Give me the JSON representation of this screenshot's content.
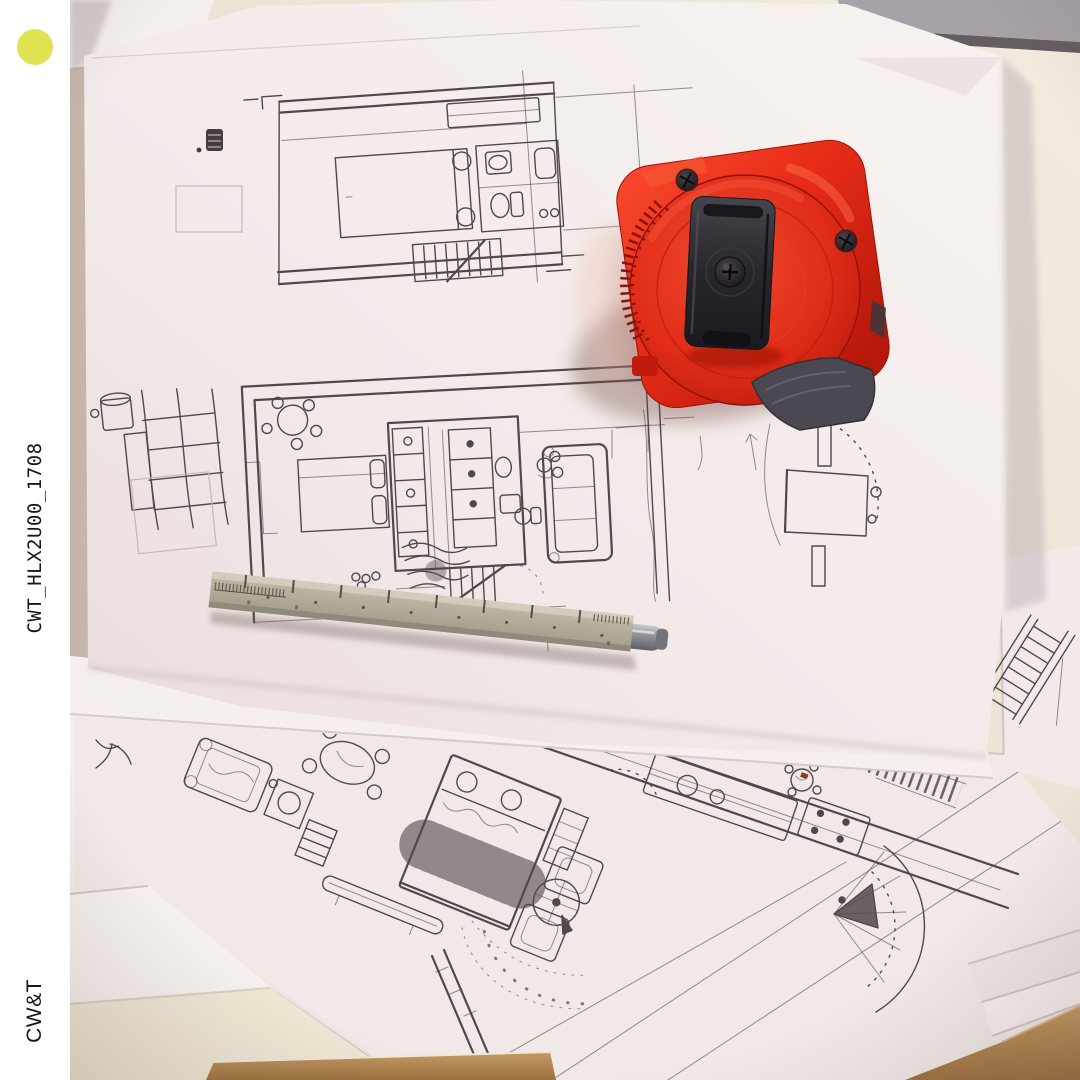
{
  "frame": {
    "background": "#ffffff"
  },
  "sidebar": {
    "dot_color": "#dde351",
    "vertical_label": "CWT_HLX2U00_1708",
    "brand": "CW&T"
  },
  "photo": {
    "alt": "Stacked sheets of hand-drawn apartment floor plan sketches on a table, with a red tape measure and a square beige ruler-pen lying on top",
    "colors": {
      "table_top": "#eae2d3",
      "shelf_gray": "#a7a1a8",
      "paper": "#f4edeb",
      "ink": "#51474c",
      "tape_measure_red": "#e73122",
      "tape_clip_black": "#26242b",
      "ruler_beige": "#b9b3a2",
      "pen_steel": "#909096",
      "wood_edge": "#b1834f"
    }
  }
}
